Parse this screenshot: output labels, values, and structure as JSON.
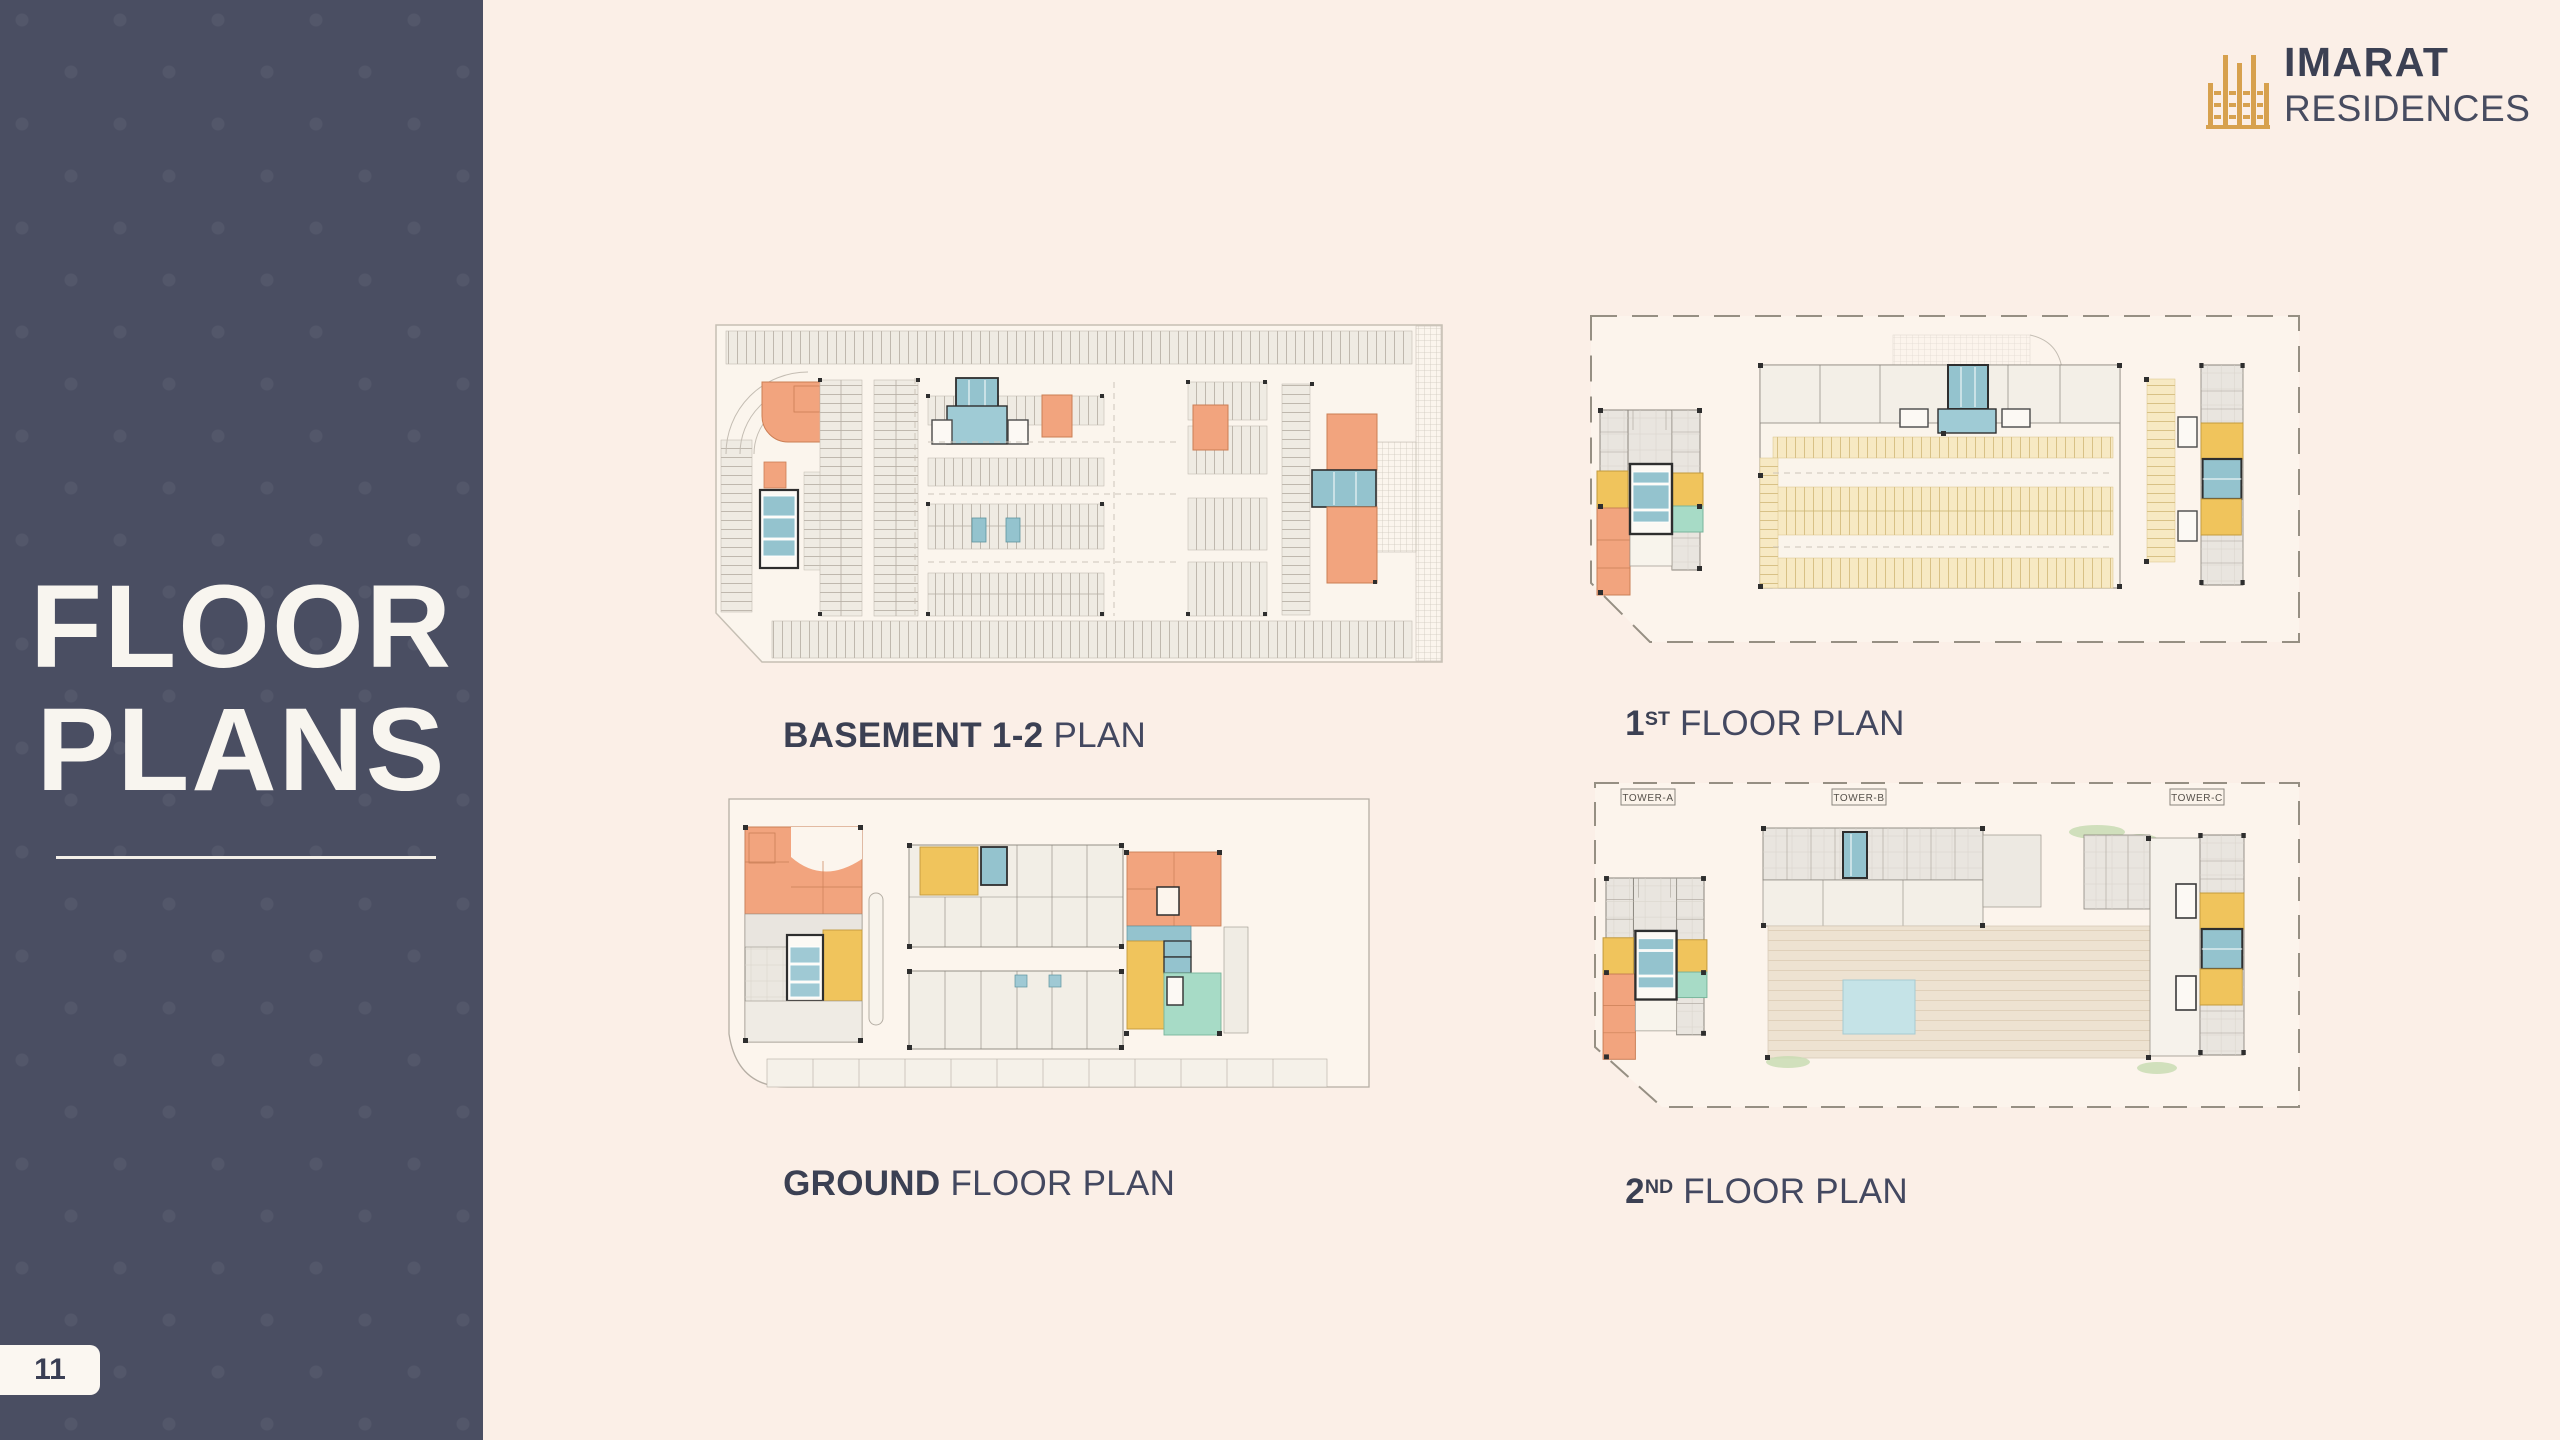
{
  "page": {
    "number": "11"
  },
  "brand": {
    "line1": "IMARAT",
    "line2": "RESIDENCES"
  },
  "sidebar": {
    "title_line1": "FLOOR",
    "title_line2": "PLANS"
  },
  "captions": {
    "basement": {
      "bold": "BASEMENT 1-2",
      "sup": "",
      "rest": " PLAN"
    },
    "first": {
      "bold": "1",
      "sup": "ST",
      "rest": " FLOOR PLAN"
    },
    "ground": {
      "bold": "GROUND",
      "sup": "",
      "rest": " FLOOR PLAN"
    },
    "second": {
      "bold": "2",
      "sup": "ND",
      "rest": " FLOOR PLAN"
    }
  },
  "second_floor": {
    "towers": [
      "TOWER-A",
      "TOWER-B",
      "TOWER-C"
    ]
  },
  "colors": {
    "background": "#FBEFE7",
    "sidebar": "#4A4E62",
    "text_navy": "#3B4053",
    "logo_gold": "#D7A14E",
    "plan_yellow": "#F0C45C",
    "plan_orange": "#F2A47E",
    "plan_blue": "#94C3CE",
    "plan_mint": "#A7DBC6",
    "parking_yellow": "#F7E9C3",
    "terrace_beige": "#EDE2D1",
    "pool_blue": "#C5E3E7",
    "unit_gray": "#E9E5DF"
  }
}
